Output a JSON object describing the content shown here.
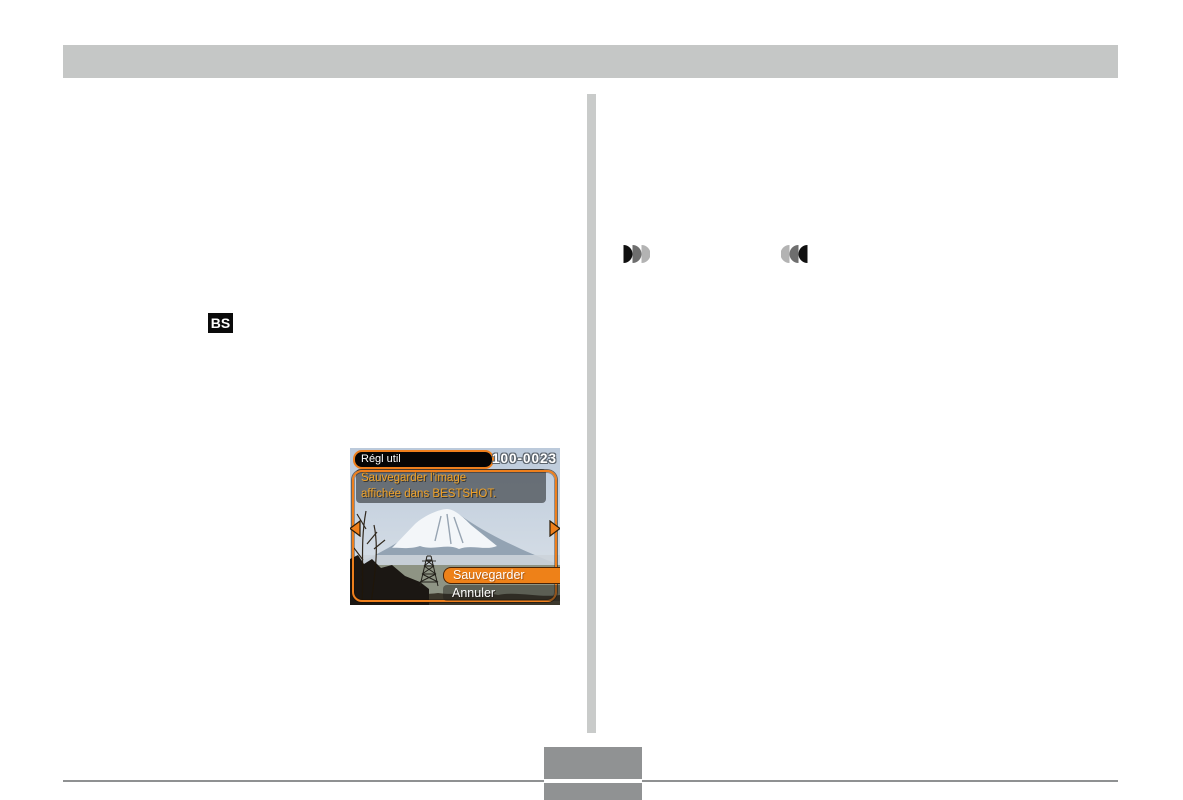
{
  "page": {
    "background": "#ffffff"
  },
  "header": {
    "bar_color": "#c5c7c6"
  },
  "divider": {
    "color": "#c9cbca"
  },
  "left_column": {
    "bestshot_button_label": "BS"
  },
  "right_column": {
    "icons": [
      {
        "name": "zoom-telephoto-icon",
        "shape": "three right-facing half-disks, black to light gray"
      },
      {
        "name": "zoom-wide-icon",
        "shape": "three left-facing half-disks, light gray to black"
      }
    ]
  },
  "camera_screen": {
    "mode_label": "Régl util",
    "image_number": "100-0023",
    "message": {
      "line1": "Sauvegarder l'image",
      "line2": "affichée dans BESTSHOT."
    },
    "menu": [
      {
        "label": "Sauvegarder",
        "selected": true
      },
      {
        "label": "Annuler",
        "selected": false
      }
    ],
    "colors": {
      "accent_orange": "#ee7f1c",
      "message_text": "#f0a228",
      "selected_bg": "#ee8118",
      "pill_bg": "#050505"
    },
    "photo_subject": "mount-fuji-snow-capped-with-transmission-tower"
  },
  "footer": {
    "line_color": "#8f9192",
    "page_box_color": "#909293"
  }
}
